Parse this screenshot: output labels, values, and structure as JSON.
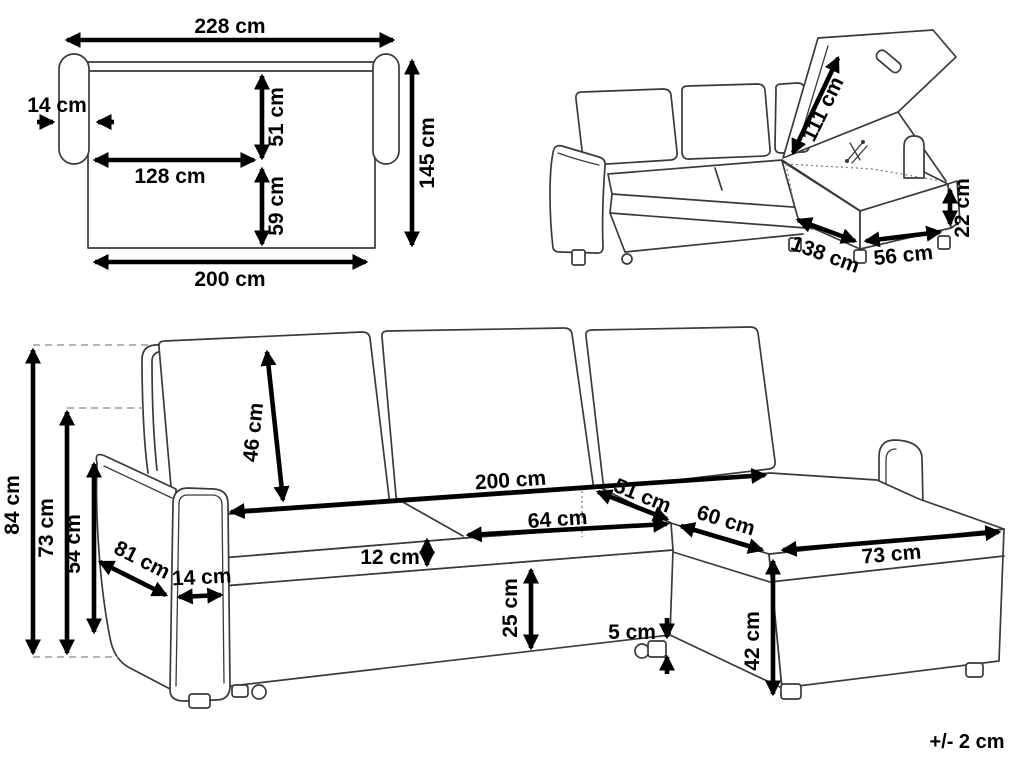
{
  "top_view": {
    "total_width": "228 cm",
    "armrest_width": "14 cm",
    "back_depth": "51 cm",
    "lying_length": "128 cm",
    "seat_depth": "59 cm",
    "total_depth": "145 cm",
    "base_width": "200 cm"
  },
  "storage_view": {
    "lid_length": "111 cm",
    "storage_height": "22 cm",
    "chaise_length": "138 cm",
    "storage_width": "56 cm"
  },
  "main_view": {
    "total_height": "84 cm",
    "backrest_height": "73 cm",
    "armrest_height": "54 cm",
    "armrest_depth": "81 cm",
    "armrest_width": "14 cm",
    "back_cushion_height": "46 cm",
    "seat_width": "200 cm",
    "seat_cushion_width": "64 cm",
    "seat_cushion_thickness": "12 cm",
    "corner_seat_depth": "51 cm",
    "chaise_width": "60 cm",
    "chaise_front_length": "73 cm",
    "base_height": "25 cm",
    "leg_height": "5 cm",
    "chaise_base_height": "42 cm"
  },
  "footer": {
    "tolerance": "+/- 2 cm"
  },
  "colors": {
    "line_art": "#3a3a3a",
    "dimension": "#000000",
    "background": "#ffffff"
  }
}
